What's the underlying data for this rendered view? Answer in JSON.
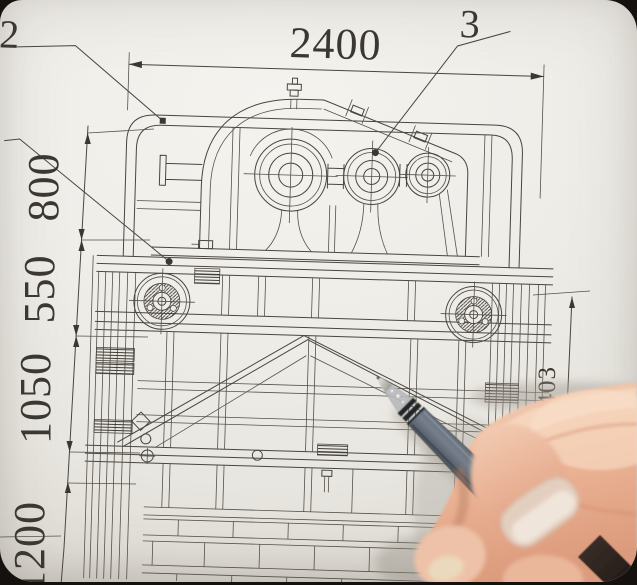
{
  "scene": {
    "type": "photograph",
    "description": "Close-up photo of a right hand holding a grey gel pen over a mechanical assembly blueprint (gearbox mounted on a welded truss frame)",
    "paper_color": "#efede8",
    "ink_color": "#45413b",
    "background_color": "#161311",
    "pen": {
      "barrel_color": "#5f6873",
      "grip_dark_color": "#23262b",
      "tip_metal_color": "#cfcec9"
    },
    "skin": {
      "base": "#eec0a5",
      "highlight": "#f6d9c2",
      "shadow": "#c98e70",
      "nail": "#e7d3c4"
    }
  },
  "drawing": {
    "dim_top": {
      "value": "2400",
      "orientation": "horizontal",
      "position": "top"
    },
    "dim_left": [
      {
        "value": "800"
      },
      {
        "value": "550"
      },
      {
        "value": "1050"
      },
      {
        "value": "1200"
      }
    ],
    "dim_right": {
      "value": "1403",
      "orientation": "vertical",
      "position": "right"
    },
    "callouts": [
      {
        "label": "2",
        "points_to": "frame top-left corner"
      },
      {
        "label": "3",
        "points_to": "gearbox middle shaft"
      }
    ]
  }
}
